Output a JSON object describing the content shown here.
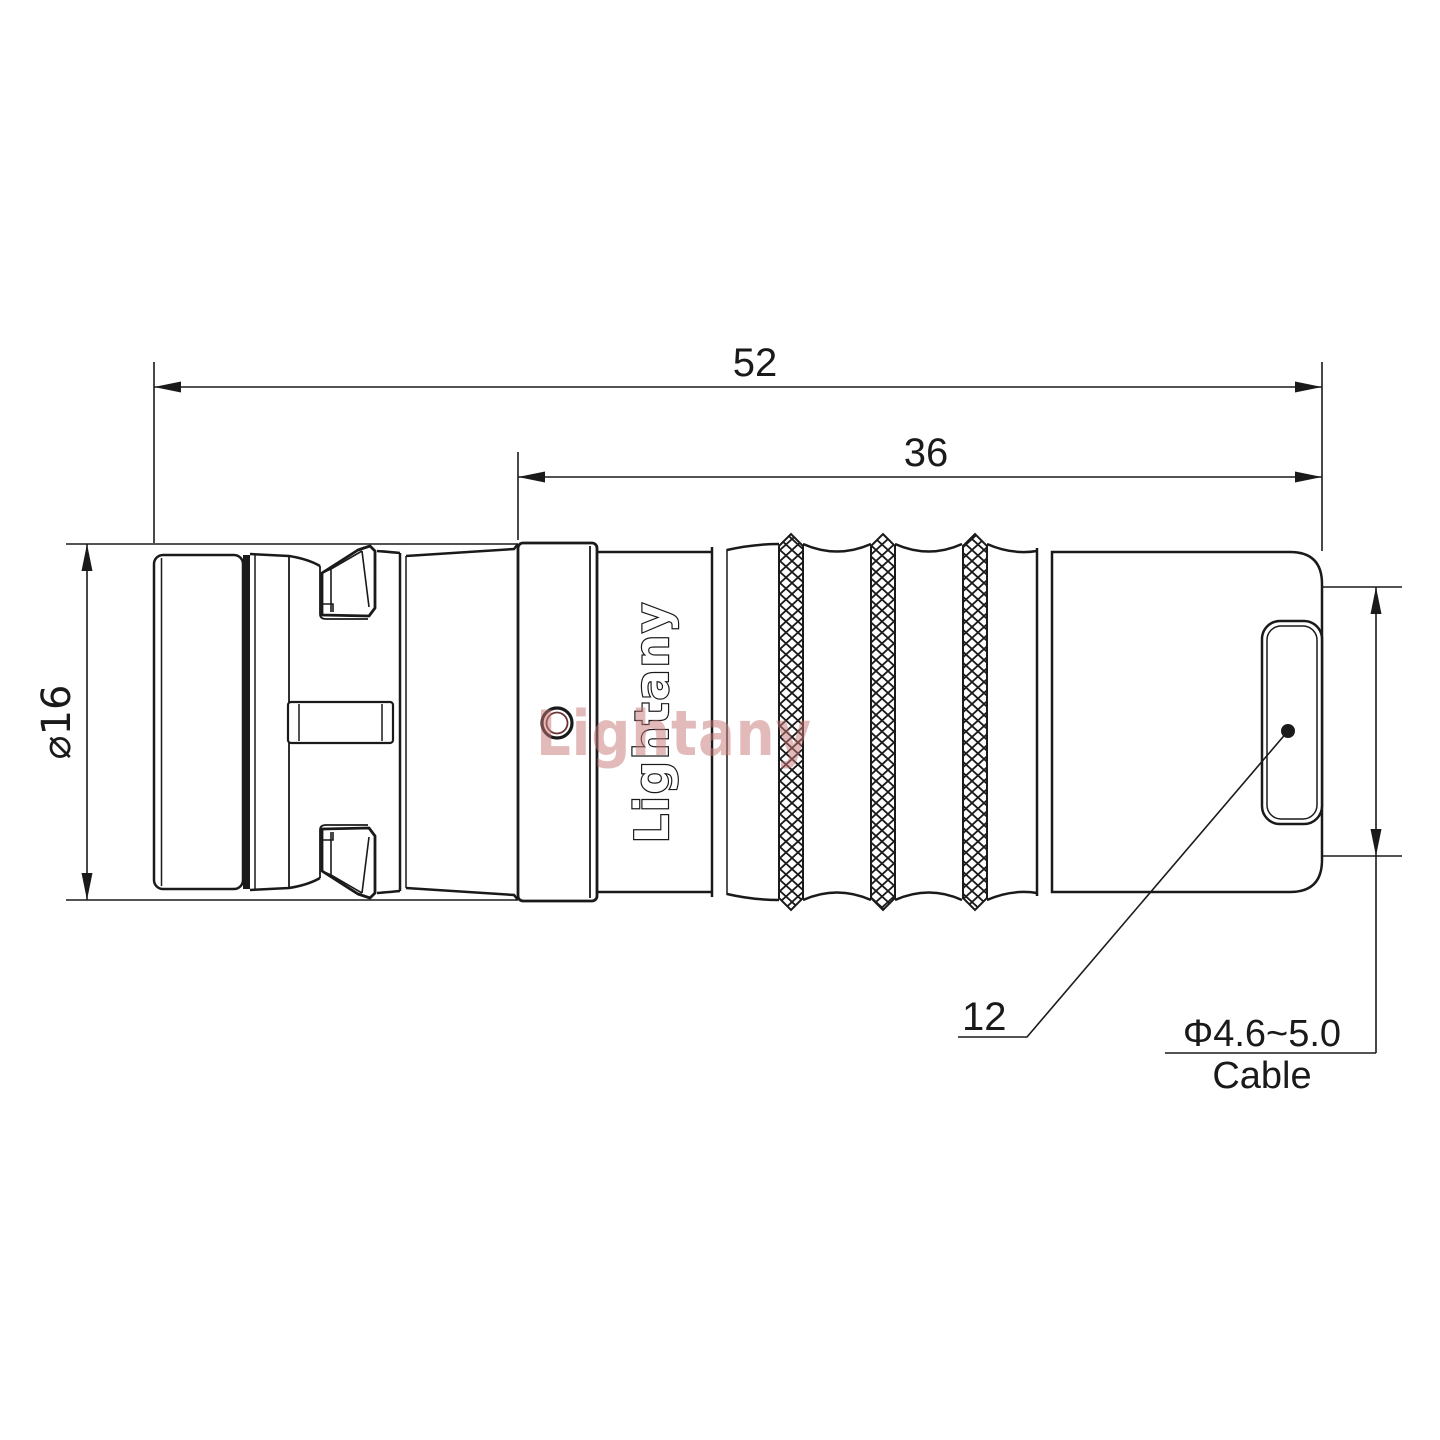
{
  "page": {
    "background": "#ffffff",
    "line_color": "#1a1a1a"
  },
  "branding": {
    "engraving": "Lightany",
    "watermark": "Lightany",
    "watermark_color": "#c97878"
  },
  "dimensions": {
    "overall_length": "52",
    "grip_length": "36",
    "shell_diameter": "⌀16",
    "boot_diameter": "12",
    "cable_range": "Φ4.6~5.0",
    "cable_word": "Cable"
  }
}
